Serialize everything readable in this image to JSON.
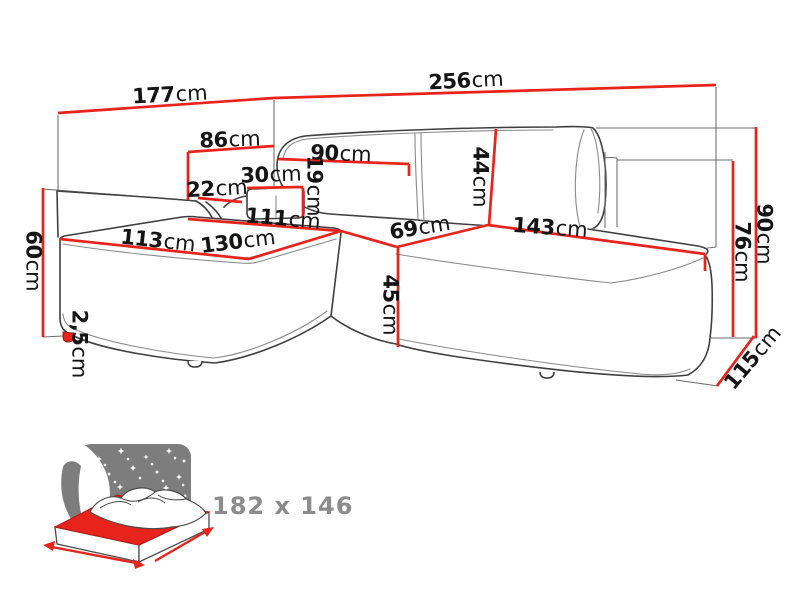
{
  "page": {
    "background": "#ffffff"
  },
  "colors": {
    "dimension_red": "#e8231c",
    "outline_dark": "#3f3f3f",
    "label_text": "#141414",
    "muted_gray": "#8c8c8c",
    "icon_sky_gray": "#7d7d7d"
  },
  "diagram": {
    "type": "furniture-dimension-diagram",
    "subject": "corner sofa with sleeping function",
    "unit": "cm",
    "dimensions": [
      {
        "id": "d177",
        "value": "177",
        "unit": "cm"
      },
      {
        "id": "d256",
        "value": "256",
        "unit": "cm"
      },
      {
        "id": "d86",
        "value": "86",
        "unit": "cm"
      },
      {
        "id": "d90top",
        "value": "90",
        "unit": "cm"
      },
      {
        "id": "d30",
        "value": "30",
        "unit": "cm"
      },
      {
        "id": "d22",
        "value": "22",
        "unit": "cm"
      },
      {
        "id": "d19",
        "value": "19",
        "unit": "cm"
      },
      {
        "id": "d111",
        "value": "111",
        "unit": "cm"
      },
      {
        "id": "d113",
        "value": "113",
        "unit": "cm"
      },
      {
        "id": "d130",
        "value": "130",
        "unit": "cm"
      },
      {
        "id": "d69",
        "value": "69",
        "unit": "cm"
      },
      {
        "id": "d143",
        "value": "143",
        "unit": "cm"
      },
      {
        "id": "d44",
        "value": "44",
        "unit": "cm"
      },
      {
        "id": "d45",
        "value": "45",
        "unit": "cm"
      },
      {
        "id": "d60",
        "value": "60",
        "unit": "cm"
      },
      {
        "id": "d25",
        "value": "2,5",
        "unit": "cm"
      },
      {
        "id": "d90right",
        "value": "90",
        "unit": "cm"
      },
      {
        "id": "d76",
        "value": "76",
        "unit": "cm"
      },
      {
        "id": "d115",
        "value": "115",
        "unit": "cm"
      }
    ],
    "sleeping_area": {
      "label": "182 x 146",
      "icon": "sofa-bed-night-icon"
    }
  }
}
